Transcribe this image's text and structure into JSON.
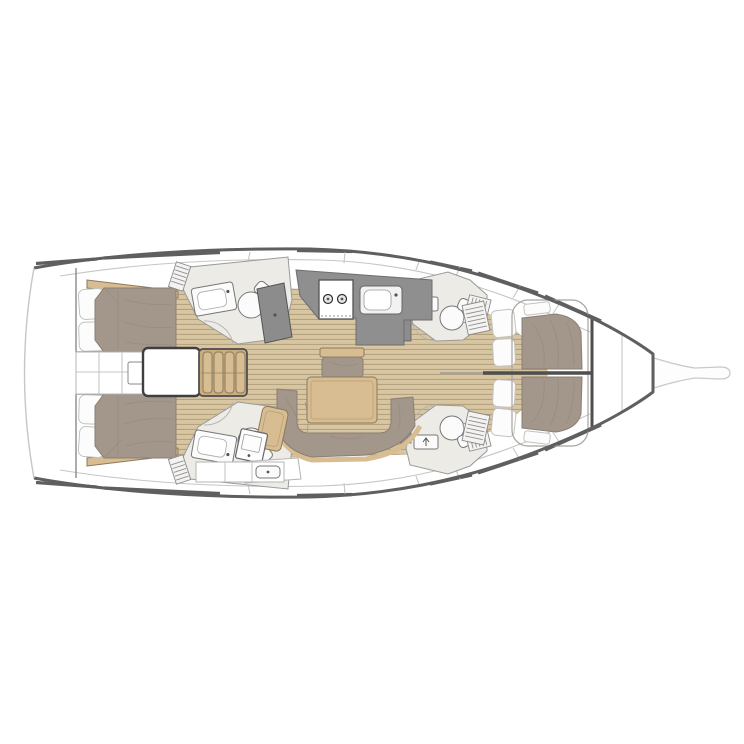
{
  "meta": {
    "description": "Top-down interior layout plan of a sailing yacht, bow pointing right: two aft double cabins, two aft heads, central companionway steps, L-shaped galley with two-burner stove and sink, saloon with table and U-shaped sofa, nav station, two forward heads with toilets and shower grates, and two forward berths with pillows, ending in an anchor locker and bowsprit."
  },
  "areas": [
    {
      "id": "aft-cabin-port",
      "label": "Aft double cabin (port)"
    },
    {
      "id": "aft-cabin-starboard",
      "label": "Aft double cabin (starboard)"
    },
    {
      "id": "aft-head-port",
      "label": "Aft head: sink, toilet, deck grate (port)"
    },
    {
      "id": "aft-head-starboard",
      "label": "Aft head: sink, toilet, counter (starboard)"
    },
    {
      "id": "companionway-steps",
      "label": "Companionway steps over engine box"
    },
    {
      "id": "galley",
      "label": "L-shaped galley with 2-burner stove and sink"
    },
    {
      "id": "wet-locker",
      "label": "Angled wet locker beside galley"
    },
    {
      "id": "saloon",
      "label": "Saloon: dining table, bench settee, U-shaped sofa"
    },
    {
      "id": "nav-station",
      "label": "Nav station with chart desk and seat"
    },
    {
      "id": "mid-head-port",
      "label": "Forward head: toilet, sink, shower grate (port)"
    },
    {
      "id": "mid-head-starboard",
      "label": "Forward head: toilet, sink, shower grate (starboard)"
    },
    {
      "id": "forward-berth-port",
      "label": "Forward berth with pillows (port)"
    },
    {
      "id": "forward-berth-starboard",
      "label": "Forward berth with pillows (starboard)"
    },
    {
      "id": "anchor-locker",
      "label": "Bow anchor locker"
    },
    {
      "id": "bowsprit",
      "label": "Bowsprit"
    }
  ],
  "colors": {
    "background": "#ffffff",
    "hull_line": "#5f5f5f",
    "deck_white": "#ffffff",
    "seam_light": "#c6c6c6",
    "teak_base": "#d8c5a2",
    "teak_stripe": "#b5a27e",
    "wood_trim": "#d8bd92",
    "wood_trim_edge": "#8a7a5e",
    "upholstery": "#a3968a",
    "upholstery_edge": "#8b7f73",
    "crease": "#958878",
    "counter_gray": "#8f8f8f",
    "counter_edge": "#6e6e6e",
    "fixture_white": "#fbfbfb",
    "fixture_edge": "#777777",
    "head_floor": "#edebe6",
    "room_edge": "#9a9a9a",
    "pillow": "#fcfcfc",
    "pillow_edge": "#c2c2c2",
    "dark_line": "#4f4f4f"
  }
}
